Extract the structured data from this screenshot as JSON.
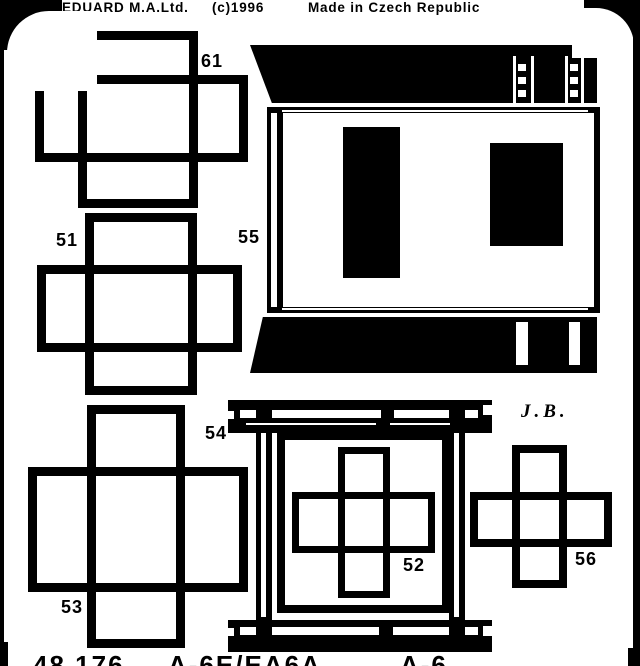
{
  "header": {
    "brand": "EDUARD M.A.Ltd.",
    "copyright": "(c)1996",
    "origin": "Made in Czech Republic"
  },
  "signature": "J.B.",
  "parts": {
    "p61": "61",
    "p51": "51",
    "p55": "55",
    "p54": "54",
    "p53": "53",
    "p52": "52",
    "p56": "56"
  },
  "footer": {
    "set_number": "48 176",
    "kit": "A-6E/EA6A",
    "suffix": "A-6"
  },
  "colors": {
    "ink": "#000000",
    "paper": "#ffffff"
  }
}
